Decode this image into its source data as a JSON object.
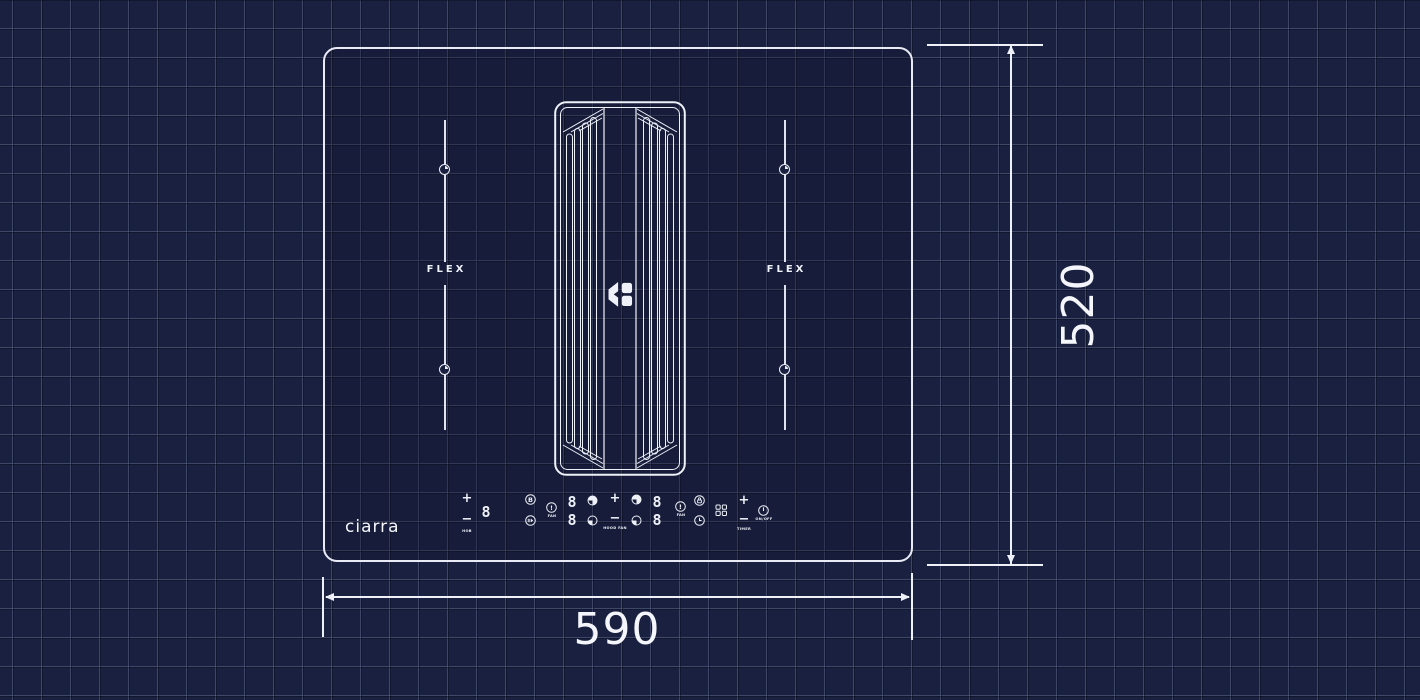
{
  "colors": {
    "background": "#1a2140",
    "grid_line": "#9aa3c3",
    "drawing_line": "#eef1f8"
  },
  "brand": {
    "logo_text": "ciarra"
  },
  "hob": {
    "flex_left_label": "FLEX",
    "flex_right_label": "FLEX"
  },
  "dimensions": {
    "width_mm": "590",
    "height_mm": "520"
  },
  "controls": {
    "zone_left": {
      "plus": "+",
      "minus": "−",
      "label": "HOB",
      "display": "8"
    },
    "boost_glyph": "B",
    "indicator_left": {
      "glyph": "!",
      "label": "FAN"
    },
    "display_left": {
      "top": "8",
      "bottom": "8"
    },
    "hood": {
      "plus": "+",
      "minus": "−",
      "label": "HOOD FAN"
    },
    "display_right": {
      "top": "8",
      "bottom": "8"
    },
    "indicator_right": {
      "glyph": "!",
      "label": "FAN"
    },
    "timer": {
      "plus": "+",
      "minus": "−",
      "label": "TIMER"
    },
    "power": {
      "label": "ON/OFF"
    }
  }
}
